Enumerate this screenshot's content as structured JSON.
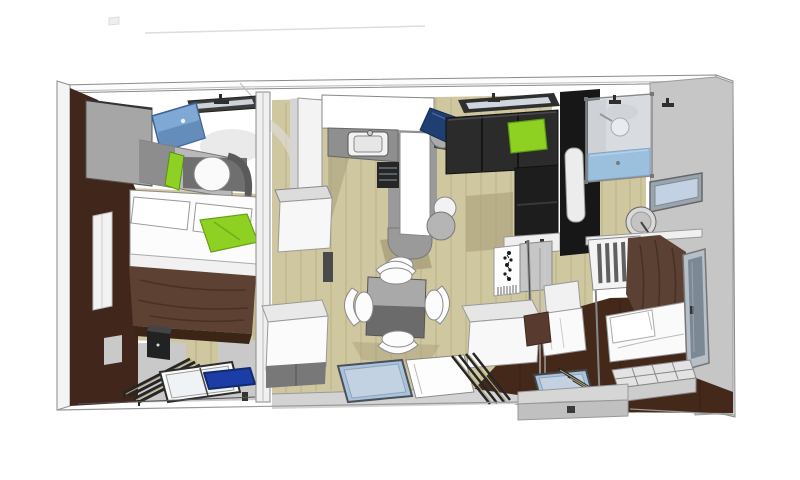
{
  "scene": {
    "type": "3d-floorplan-render",
    "view": "top-down cutaway of a holiday lodge",
    "rooms": [
      {
        "name": "master-bedroom",
        "position": "left",
        "items": [
          "brown-accent-wall",
          "wall-window",
          "overhead-cabinet",
          "wall-tv",
          "tv-cabinet",
          "green-accent-panel",
          "roll-pillow",
          "headboard-arch",
          "double-bed",
          "bed-pillows",
          "green-pillow",
          "white-sheet",
          "brown-duvet",
          "bedside-cabinet",
          "slatted-bench",
          "floor-window",
          "blue-mat",
          "ceiling-window",
          "ceiling-spotlight"
        ]
      },
      {
        "name": "living-kitchen",
        "position": "center",
        "items": [
          "tall-cabinet",
          "wall-cabinet",
          "storage-cube",
          "kitchen-counter",
          "kitchen-sink",
          "oven",
          "cooktop-appliance",
          "counter-armchair",
          "white-stool",
          "dining-table",
          "dining-chair-top",
          "dining-chair-left",
          "dining-chair-right",
          "dining-chair-bottom",
          "corner-sofa",
          "green-cushion",
          "sofa-drawer",
          "ceiling-window",
          "room-divider-panel",
          "divider-pole",
          "floor-window",
          "door-panel",
          "window-blinds",
          "entry-step"
        ]
      },
      {
        "name": "bathroom",
        "position": "top-right",
        "items": [
          "black-feature-wall",
          "wall-mirror",
          "shower-cabin",
          "shower-head",
          "shower-tray",
          "wall-window",
          "satellite-dish",
          "shelf-rail"
        ]
      },
      {
        "name": "kids-bedroom",
        "position": "bottom-right",
        "items": [
          "bunk-ladder",
          "brown-bedding",
          "bed",
          "bed-pillow",
          "white-chair",
          "storage-box",
          "brown-cushion",
          "wall-window",
          "storage-drawers",
          "floor-window",
          "window-blinds"
        ]
      }
    ]
  },
  "colors": {
    "bg": "#ffffff",
    "paper": "#fcfcfc",
    "wall": "#f4f4f4",
    "wall_line": "#8a8a8a",
    "faint_line": "#dddddd",
    "edge": "#555555",
    "ink": "#262626",
    "wall_gray": "#c6c6c6",
    "cab_gray": "#a6a6a6",
    "mid_gray": "#b9b9b9",
    "dark_gray": "#6f6f6f",
    "floor_gray": "#c9c9c9",
    "floor_light": "#d3d3d3",
    "deck": "#d6d6d6",
    "deck_front": "#c0c0c0",
    "wood": "#cfc79f",
    "wood_streak": "#b0a67d",
    "wood_shadow": "#a89f7b",
    "brown_wall": "#40261b",
    "brown_floor": "#44291b",
    "duvet": "#5d4133",
    "duvet_dark": "#3a2517",
    "drape": "#5b4134",
    "cushion_brown": "#583a2e",
    "lime": "#8ed123",
    "lime_dark": "#5f9e10",
    "tv_blue": "#7fa8d4",
    "tv_blue_dark": "#5b84b4",
    "navy": "#1f3f72",
    "glass_blue": "#a9c3dd",
    "glass_light": "#c2d2e3",
    "glass_tint": "rgba(214,225,235,0.42)",
    "shower_blue": "#6fa9d3",
    "mat_blue": "#1c3da5",
    "sofa_black": "#2b2b2b",
    "sofa_dark": "#1d1d1d",
    "black_wall": "#171717"
  }
}
